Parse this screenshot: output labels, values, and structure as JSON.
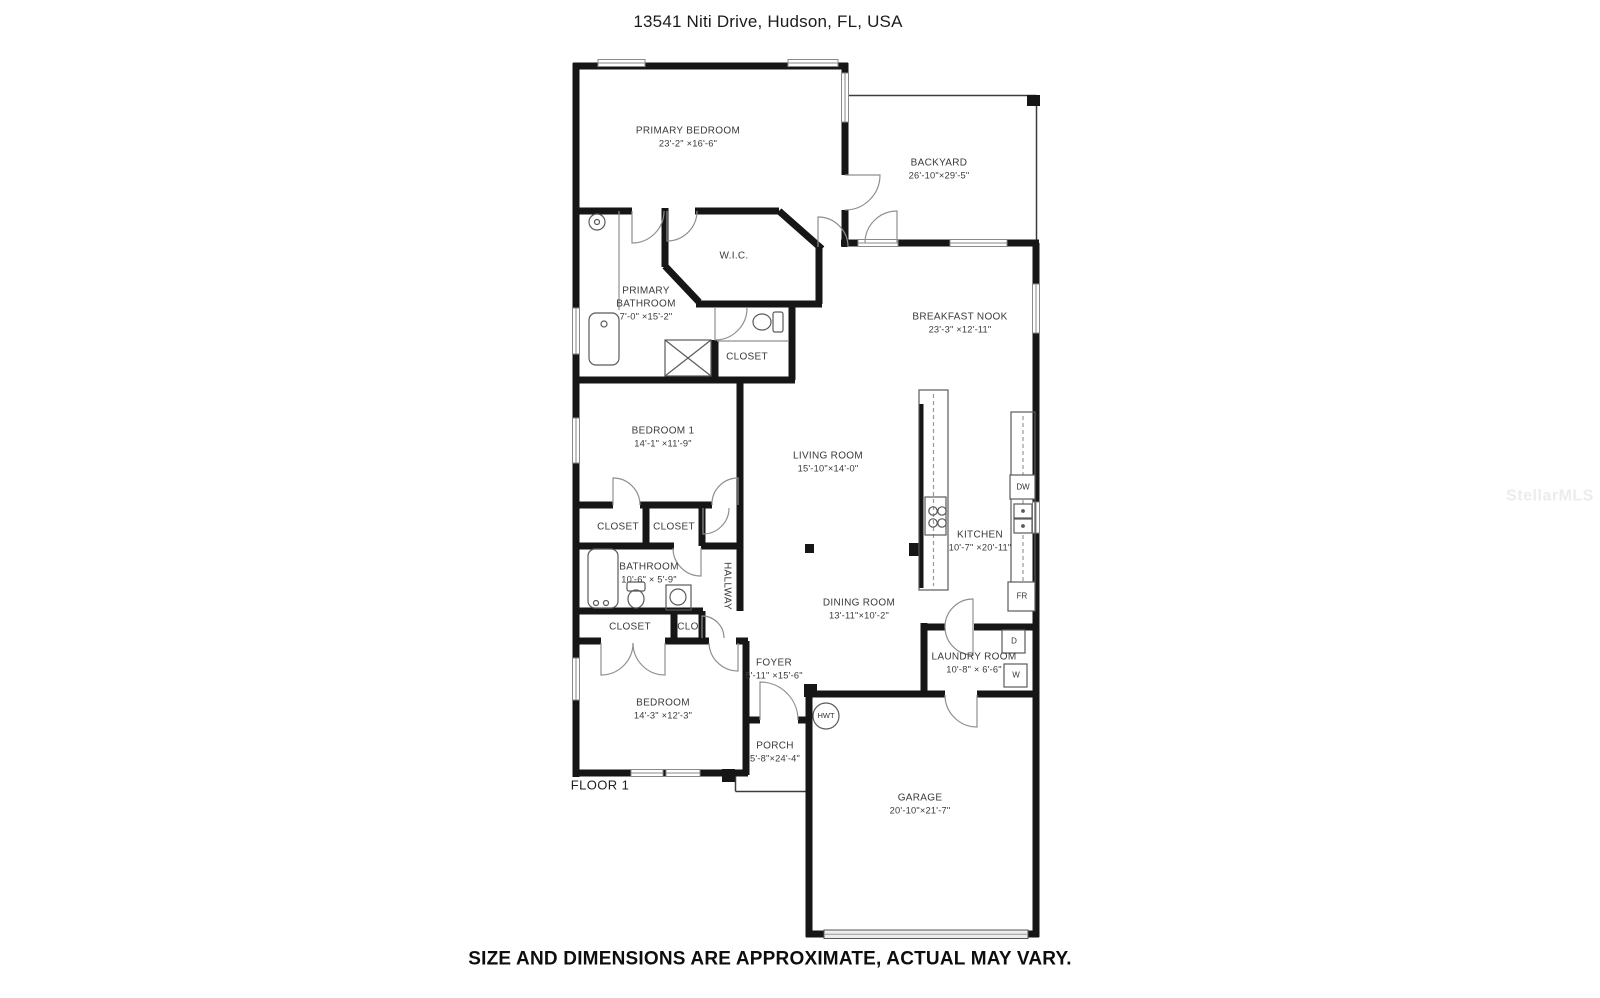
{
  "header": {
    "title": "13541 Niti Drive, Hudson, FL, USA"
  },
  "floor_label": "FLOOR 1",
  "footer": {
    "disclaimer": "SIZE AND DIMENSIONS ARE APPROXIMATE, ACTUAL MAY VARY."
  },
  "watermark": "StellarMLS",
  "colors": {
    "wall": "#161616",
    "text": "#3a3a3a",
    "fixture": "#5a5a5a",
    "watermark": "#ececec"
  },
  "rooms": {
    "primary_bedroom": {
      "name": "PRIMARY BEDROOM",
      "dims": "23'-2\" ×16'-6\""
    },
    "backyard": {
      "name": "BACKYARD",
      "dims": "26'-10\"×29'-5\""
    },
    "wic": {
      "name": "W.I.C."
    },
    "primary_bathroom": {
      "name": "PRIMARY BATHROOM",
      "dims": "7'-0\" ×15'-2\""
    },
    "closet_primary": {
      "name": "CLOSET"
    },
    "breakfast_nook": {
      "name": "BREAKFAST NOOK",
      "dims": "23'-3\" ×12'-11\""
    },
    "bedroom_1": {
      "name": "BEDROOM 1",
      "dims": "14'-1\" ×11'-9\""
    },
    "living_room": {
      "name": "LIVING ROOM",
      "dims": "15'-10\"×14'-0\""
    },
    "kitchen": {
      "name": "KITCHEN",
      "dims": "10'-7\" ×20'-11\""
    },
    "closet_a": {
      "name": "CLOSET"
    },
    "closet_b": {
      "name": "CLOSET"
    },
    "bathroom": {
      "name": "BATHROOM",
      "dims": "10'-6\" × 5'-9\""
    },
    "hallway": {
      "name": "HALLWAY"
    },
    "closet_c": {
      "name": "CLOSET"
    },
    "clo": {
      "name": "CLO"
    },
    "dining_room": {
      "name": "DINING ROOM",
      "dims": "13'-11\"×10'-2\""
    },
    "laundry_room": {
      "name": "LAUNDRY ROOM",
      "dims": "10'-8\" × 6'-6\""
    },
    "foyer": {
      "name": "FOYER",
      "dims": "5'-11\" ×15'-6\""
    },
    "bedroom_2": {
      "name": "BEDROOM",
      "dims": "14'-3\" ×12'-3\""
    },
    "porch": {
      "name": "PORCH",
      "dims": "5'-8\"×24'-4\""
    },
    "garage": {
      "name": "GARAGE",
      "dims": "20'-10\"×21'-7\""
    }
  },
  "appliances": {
    "dishwasher": "DW",
    "refrigerator": "FR",
    "dryer": "D",
    "washer": "W",
    "water_heater": "HWT"
  }
}
